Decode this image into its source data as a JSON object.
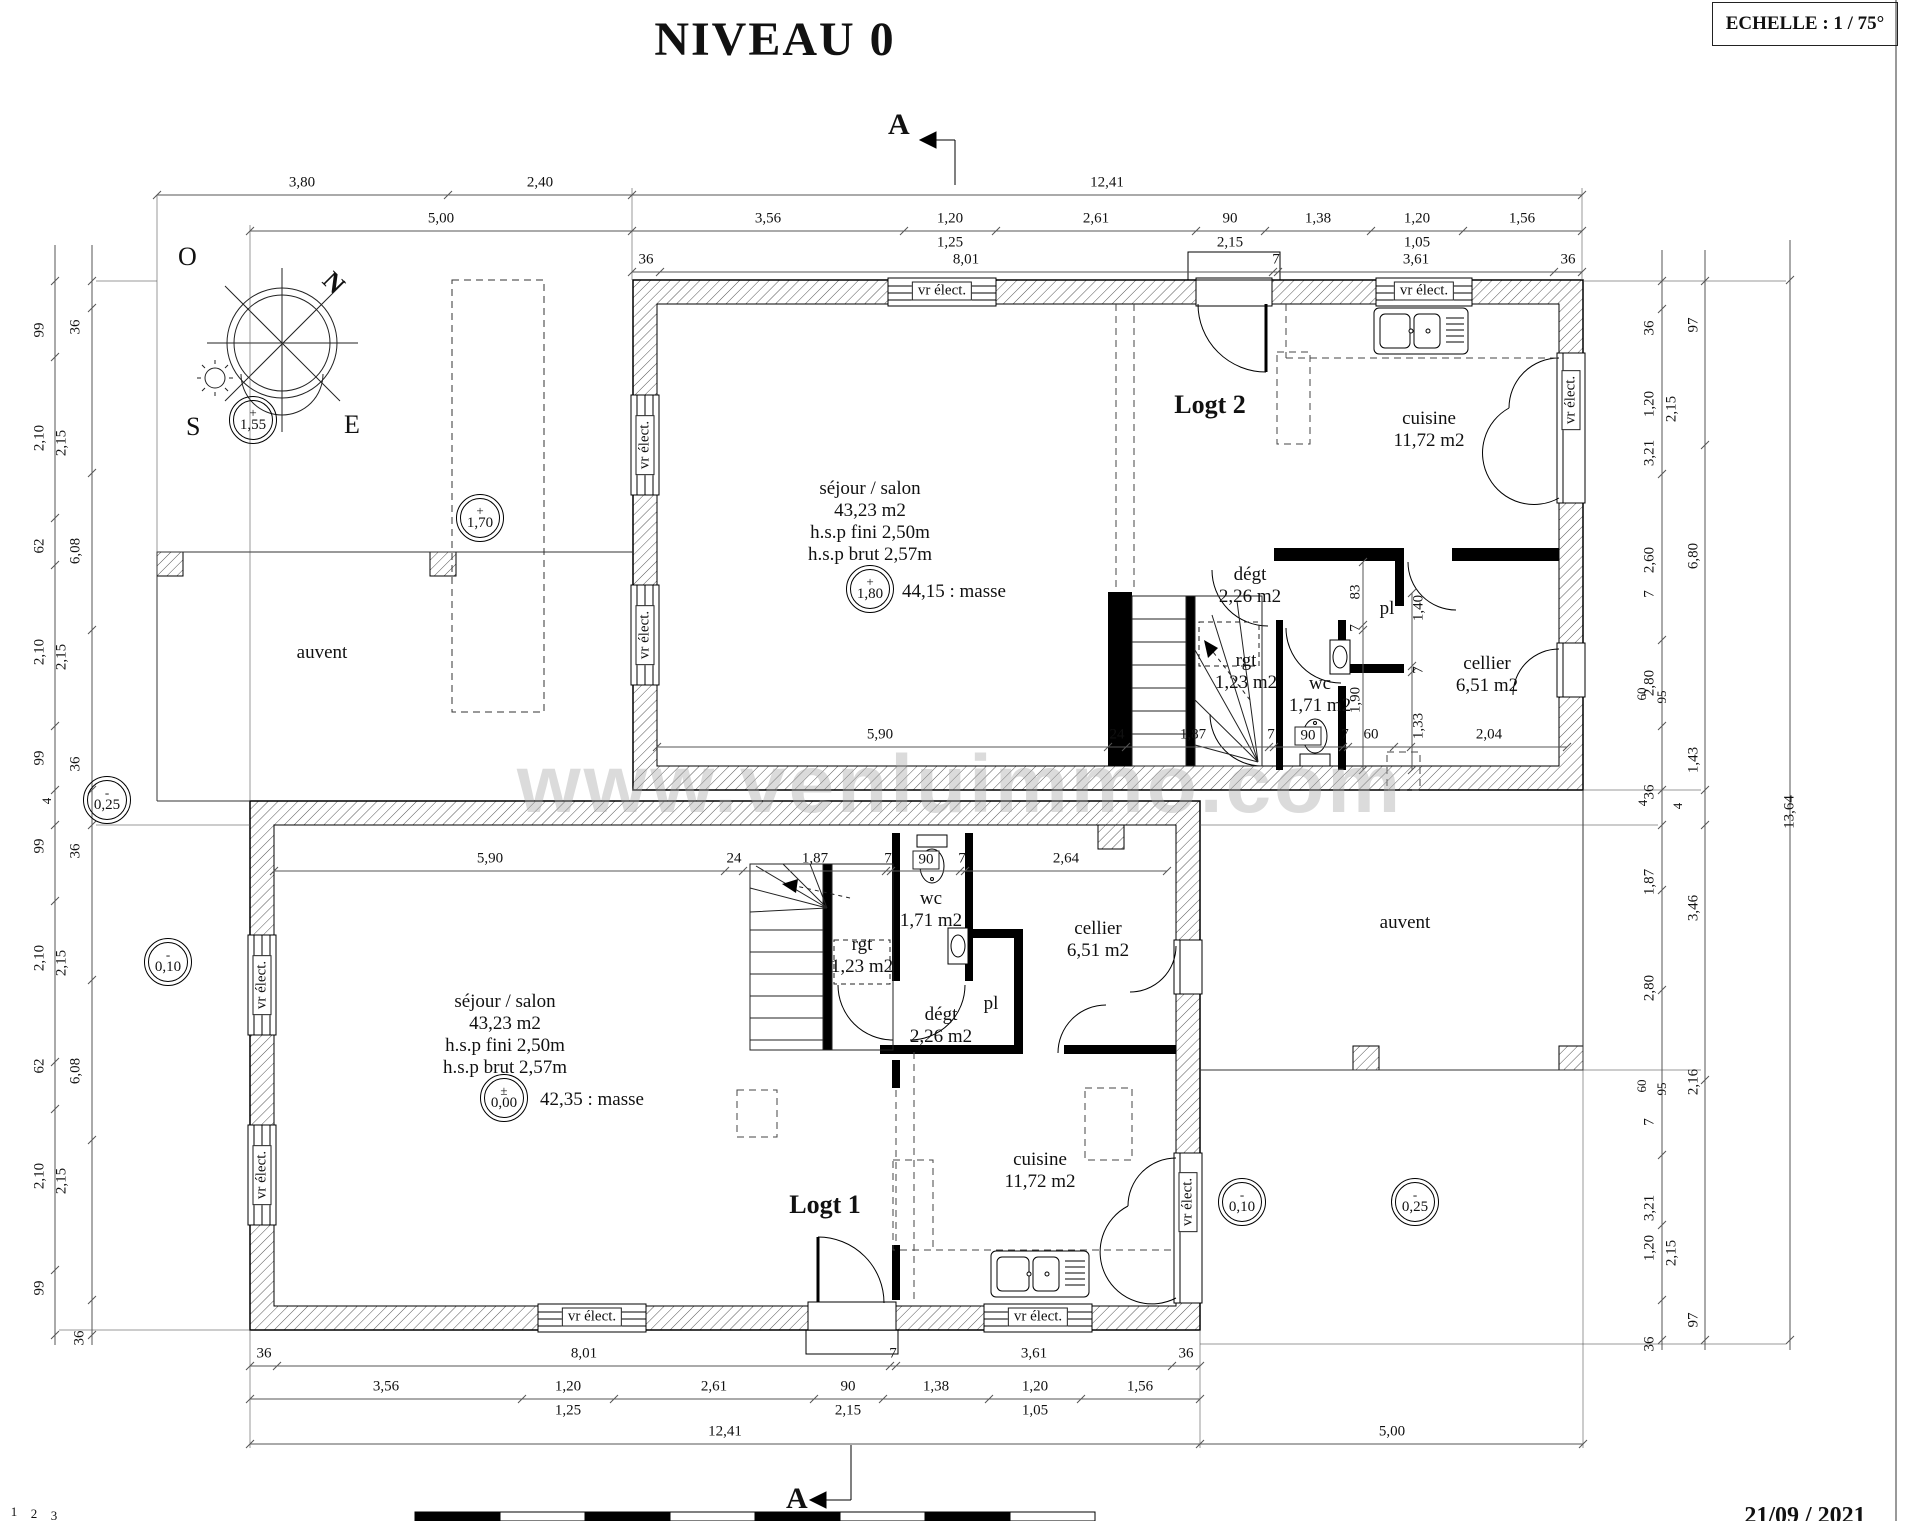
{
  "sheet": {
    "title": "NIVEAU 0",
    "scale_label": "ECHELLE : 1 / 75°",
    "section_letter": "A",
    "date": "21/09 / 2021",
    "watermark": "www.venluimmo.com"
  },
  "compass": {
    "west": "O",
    "south": "S",
    "east": "E",
    "north": "N"
  },
  "site": {
    "auvent_left": "auvent",
    "auvent_right": "auvent"
  },
  "apartments": {
    "logt2": {
      "label": "Logt 2",
      "sejour": [
        "séjour / salon",
        "43,23 m2",
        "h.s.p fini 2,50m",
        "h.s.p brut 2,57m"
      ],
      "masse": "44,15 : masse",
      "cuisine": [
        "cuisine",
        "11,72 m2"
      ],
      "cellier": [
        "cellier",
        "6,51 m2"
      ],
      "wc": [
        "wc",
        "1,71 m2"
      ],
      "rgt": [
        "rgt",
        "1,23 m2"
      ],
      "degt": [
        "dégt",
        "2,26 m2"
      ],
      "pl": "pl"
    },
    "logt1": {
      "label": "Logt 1",
      "sejour": [
        "séjour / salon",
        "43,23 m2",
        "h.s.p fini 2,50m",
        "h.s.p brut 2,57m"
      ],
      "masse": "42,35 : masse",
      "cuisine": [
        "cuisine",
        "11,72 m2"
      ],
      "cellier": [
        "cellier",
        "6,51 m2"
      ],
      "wc": [
        "wc",
        "1,71 m2"
      ],
      "rgt": [
        "rgt",
        "1,23 m2"
      ],
      "degt": [
        "dégt",
        "2,26 m2"
      ],
      "pl": "pl"
    }
  },
  "levels": [
    {
      "sign": "+",
      "value": "1,55",
      "x": 253,
      "y": 420
    },
    {
      "sign": "+",
      "value": "1,70",
      "x": 480,
      "y": 518
    },
    {
      "sign": "+",
      "value": "1,80",
      "x": 870,
      "y": 589
    },
    {
      "sign": "±",
      "value": "0,00",
      "x": 504,
      "y": 1098
    },
    {
      "sign": "-",
      "value": "0,25",
      "x": 107,
      "y": 800
    },
    {
      "sign": "-",
      "value": "0,10",
      "x": 168,
      "y": 962
    },
    {
      "sign": "-",
      "value": "0,10",
      "x": 1242,
      "y": 1202
    },
    {
      "sign": "-",
      "value": "0,25",
      "x": 1415,
      "y": 1202
    }
  ],
  "annotations": [
    {
      "t": "3,80",
      "x": 302,
      "y": 183
    },
    {
      "t": "2,40",
      "x": 540,
      "y": 183
    },
    {
      "t": "12,41",
      "x": 1107,
      "y": 183
    },
    {
      "t": "5,00",
      "x": 441,
      "y": 219
    },
    {
      "t": "3,56",
      "x": 768,
      "y": 219
    },
    {
      "t": "1,20",
      "x": 950,
      "y": 219
    },
    {
      "t": "2,61",
      "x": 1096,
      "y": 219
    },
    {
      "t": "90",
      "x": 1230,
      "y": 219
    },
    {
      "t": "1,38",
      "x": 1318,
      "y": 219
    },
    {
      "t": "1,20",
      "x": 1417,
      "y": 219
    },
    {
      "t": "1,56",
      "x": 1522,
      "y": 219
    },
    {
      "t": "1,25",
      "x": 950,
      "y": 243
    },
    {
      "t": "2,15",
      "x": 1230,
      "y": 243
    },
    {
      "t": "1,05",
      "x": 1417,
      "y": 243
    },
    {
      "t": "36",
      "x": 646,
      "y": 260
    },
    {
      "t": "8,01",
      "x": 966,
      "y": 260
    },
    {
      "t": "7",
      "x": 1276,
      "y": 260
    },
    {
      "t": "3,61",
      "x": 1416,
      "y": 260
    },
    {
      "t": "36",
      "x": 1568,
      "y": 260
    },
    {
      "t": "36",
      "x": 264,
      "y": 1354
    },
    {
      "t": "8,01",
      "x": 584,
      "y": 1354
    },
    {
      "t": "7",
      "x": 893,
      "y": 1354
    },
    {
      "t": "3,61",
      "x": 1034,
      "y": 1354
    },
    {
      "t": "36",
      "x": 1186,
      "y": 1354
    },
    {
      "t": "3,56",
      "x": 386,
      "y": 1387
    },
    {
      "t": "1,20",
      "x": 568,
      "y": 1387
    },
    {
      "t": "2,61",
      "x": 714,
      "y": 1387
    },
    {
      "t": "90",
      "x": 848,
      "y": 1387
    },
    {
      "t": "1,38",
      "x": 936,
      "y": 1387
    },
    {
      "t": "1,20",
      "x": 1035,
      "y": 1387
    },
    {
      "t": "1,56",
      "x": 1140,
      "y": 1387
    },
    {
      "t": "1,25",
      "x": 568,
      "y": 1411
    },
    {
      "t": "2,15",
      "x": 848,
      "y": 1411
    },
    {
      "t": "1,05",
      "x": 1035,
      "y": 1411
    },
    {
      "t": "12,41",
      "x": 725,
      "y": 1432
    },
    {
      "t": "5,00",
      "x": 1392,
      "y": 1432
    },
    {
      "t": "99",
      "x": 40,
      "y": 330,
      "r": -90
    },
    {
      "t": "36",
      "x": 76,
      "y": 327,
      "r": -90
    },
    {
      "t": "2,10",
      "x": 40,
      "y": 438,
      "r": -90
    },
    {
      "t": "2,15",
      "x": 62,
      "y": 443,
      "r": -90
    },
    {
      "t": "62",
      "x": 40,
      "y": 546,
      "r": -90
    },
    {
      "t": "6,08",
      "x": 76,
      "y": 551,
      "r": -90
    },
    {
      "t": "2,10",
      "x": 40,
      "y": 652,
      "r": -90
    },
    {
      "t": "2,15",
      "x": 62,
      "y": 657,
      "r": -90
    },
    {
      "t": "99",
      "x": 40,
      "y": 758,
      "r": -90
    },
    {
      "t": "36",
      "x": 76,
      "y": 764,
      "r": -90
    },
    {
      "t": "4",
      "x": 47,
      "y": 801,
      "r": -90,
      "fs": 13
    },
    {
      "t": "99",
      "x": 40,
      "y": 846,
      "r": -90
    },
    {
      "t": "36",
      "x": 76,
      "y": 851,
      "r": -90
    },
    {
      "t": "2,10",
      "x": 40,
      "y": 958,
      "r": -90
    },
    {
      "t": "2,15",
      "x": 62,
      "y": 963,
      "r": -90
    },
    {
      "t": "62",
      "x": 40,
      "y": 1066,
      "r": -90
    },
    {
      "t": "6,08",
      "x": 76,
      "y": 1071,
      "r": -90
    },
    {
      "t": "2,10",
      "x": 40,
      "y": 1176,
      "r": -90
    },
    {
      "t": "2,15",
      "x": 62,
      "y": 1181,
      "r": -90
    },
    {
      "t": "99",
      "x": 40,
      "y": 1288,
      "r": -90
    },
    {
      "t": "36",
      "x": 80,
      "y": 1338,
      "r": -90
    },
    {
      "t": "36",
      "x": 1650,
      "y": 328,
      "r": -90
    },
    {
      "t": "97",
      "x": 1694,
      "y": 325,
      "r": -90
    },
    {
      "t": "1,20",
      "x": 1650,
      "y": 404,
      "r": -90
    },
    {
      "t": "2,15",
      "x": 1672,
      "y": 409,
      "r": -90
    },
    {
      "t": "3,21",
      "x": 1650,
      "y": 453,
      "r": -90
    },
    {
      "t": "2,60",
      "x": 1650,
      "y": 560,
      "r": -90
    },
    {
      "t": "6,80",
      "x": 1694,
      "y": 556,
      "r": -90
    },
    {
      "t": "7",
      "x": 1650,
      "y": 594,
      "r": -90
    },
    {
      "t": "2,80",
      "x": 1650,
      "y": 683,
      "r": -90
    },
    {
      "t": "60",
      "x": 1642,
      "y": 694,
      "r": -90,
      "fs": 13
    },
    {
      "t": "95",
      "x": 1662,
      "y": 697,
      "r": -90,
      "fs": 13
    },
    {
      "t": "1,43",
      "x": 1694,
      "y": 760,
      "r": -90
    },
    {
      "t": "36",
      "x": 1650,
      "y": 792,
      "r": -90
    },
    {
      "t": "4",
      "x": 1643,
      "y": 803,
      "r": -90,
      "fs": 13
    },
    {
      "t": "4",
      "x": 1678,
      "y": 806,
      "r": -90,
      "fs": 13
    },
    {
      "t": "13,64",
      "x": 1790,
      "y": 812,
      "r": -90
    },
    {
      "t": "1,87",
      "x": 1650,
      "y": 882,
      "r": -90
    },
    {
      "t": "3,46",
      "x": 1694,
      "y": 908,
      "r": -90
    },
    {
      "t": "2,80",
      "x": 1650,
      "y": 988,
      "r": -90
    },
    {
      "t": "60",
      "x": 1642,
      "y": 1086,
      "r": -90,
      "fs": 13
    },
    {
      "t": "95",
      "x": 1662,
      "y": 1089,
      "r": -90,
      "fs": 13
    },
    {
      "t": "2,16",
      "x": 1694,
      "y": 1082,
      "r": -90
    },
    {
      "t": "7",
      "x": 1650,
      "y": 1122,
      "r": -90
    },
    {
      "t": "3,21",
      "x": 1650,
      "y": 1208,
      "r": -90
    },
    {
      "t": "1,20",
      "x": 1650,
      "y": 1248,
      "r": -90
    },
    {
      "t": "2,15",
      "x": 1672,
      "y": 1253,
      "r": -90
    },
    {
      "t": "97",
      "x": 1694,
      "y": 1320,
      "r": -90
    },
    {
      "t": "36",
      "x": 1650,
      "y": 1344,
      "r": -90
    },
    {
      "t": "5,90",
      "x": 880,
      "y": 735
    },
    {
      "t": "24",
      "x": 1117,
      "y": 735
    },
    {
      "t": "1,87",
      "x": 1193,
      "y": 735
    },
    {
      "t": "7",
      "x": 1271,
      "y": 735
    },
    {
      "t": "90",
      "x": 1308,
      "y": 736,
      "bx": 1
    },
    {
      "t": "7",
      "x": 1345,
      "y": 735
    },
    {
      "t": "60",
      "x": 1371,
      "y": 735
    },
    {
      "t": "2,04",
      "x": 1489,
      "y": 735
    },
    {
      "t": "1,33",
      "x": 1419,
      "y": 726,
      "r": -90
    },
    {
      "t": "83",
      "x": 1356,
      "y": 592,
      "r": -90
    },
    {
      "t": "7",
      "x": 1356,
      "y": 628,
      "r": -90
    },
    {
      "t": "1,90",
      "x": 1356,
      "y": 700,
      "r": -90
    },
    {
      "t": "1,40",
      "x": 1419,
      "y": 608,
      "r": -90
    },
    {
      "t": "7",
      "x": 1419,
      "y": 670,
      "r": -90
    },
    {
      "t": "5,90",
      "x": 490,
      "y": 859
    },
    {
      "t": "24",
      "x": 734,
      "y": 859
    },
    {
      "t": "1,87",
      "x": 815,
      "y": 859
    },
    {
      "t": "7",
      "x": 888,
      "y": 859
    },
    {
      "t": "90",
      "x": 926,
      "y": 860,
      "bx": 1
    },
    {
      "t": "7",
      "x": 962,
      "y": 859
    },
    {
      "t": "2,64",
      "x": 1066,
      "y": 859
    },
    {
      "n": "vr-elect-label",
      "t": "vr élect.",
      "x": 942,
      "y": 291,
      "bx": 1
    },
    {
      "n": "vr-elect-label",
      "t": "vr élect.",
      "x": 1424,
      "y": 291,
      "bx": 1
    },
    {
      "n": "vr-elect-label",
      "t": "vr élect.",
      "x": 645,
      "y": 445,
      "r": -90,
      "bx": 1
    },
    {
      "n": "vr-elect-label",
      "t": "vr élect.",
      "x": 645,
      "y": 635,
      "r": -90,
      "bx": 1
    },
    {
      "n": "vr-elect-label",
      "t": "vr élect.",
      "x": 1571,
      "y": 400,
      "r": -90,
      "bx": 1
    },
    {
      "n": "vr-elect-label",
      "t": "vr élect.",
      "x": 262,
      "y": 985,
      "r": -90,
      "bx": 1
    },
    {
      "n": "vr-elect-label",
      "t": "vr élect.",
      "x": 262,
      "y": 1175,
      "r": -90,
      "bx": 1
    },
    {
      "n": "vr-elect-label",
      "t": "vr élect.",
      "x": 592,
      "y": 1317,
      "bx": 1
    },
    {
      "n": "vr-elect-label",
      "t": "vr élect.",
      "x": 1038,
      "y": 1317,
      "bx": 1
    },
    {
      "n": "vr-elect-label",
      "t": "vr élect.",
      "x": 1188,
      "y": 1202,
      "r": -90,
      "bx": 1
    },
    {
      "n": "page-mark",
      "t": "1",
      "x": 14,
      "y": 1512,
      "fs": 13
    },
    {
      "n": "page-mark",
      "t": "2",
      "x": 34,
      "y": 1514,
      "fs": 13
    },
    {
      "n": "page-mark",
      "t": "3",
      "x": 54,
      "y": 1516,
      "fs": 13
    }
  ]
}
